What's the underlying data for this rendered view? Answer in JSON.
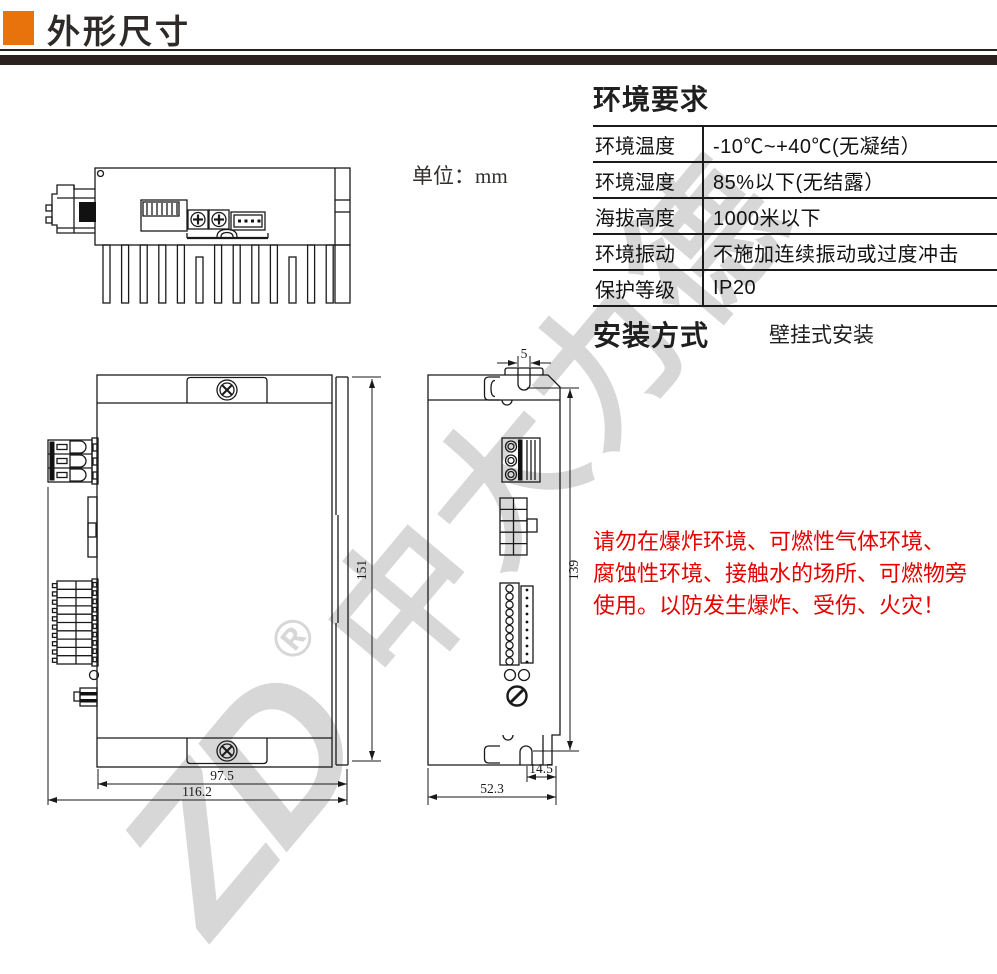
{
  "header": {
    "title": "外形尺寸"
  },
  "unit": {
    "label": "单位：",
    "value": "mm"
  },
  "environment": {
    "heading": "环境要求",
    "rows": [
      {
        "label": "环境温度",
        "value": "-10℃~+40℃(无凝结）"
      },
      {
        "label": "环境湿度",
        "value": "85%以下(无结露）"
      },
      {
        "label": "海拔高度",
        "value": "1000米以下"
      },
      {
        "label": "环境振动",
        "value": "不施加连续振动或过度冲击"
      },
      {
        "label": "保护等级",
        "value": "IP20"
      }
    ]
  },
  "installation": {
    "heading": "安装方式",
    "value": "壁挂式安装"
  },
  "warning": {
    "color": "#e60000",
    "lines": [
      "请勿在爆炸环境、可燃性气体环境、",
      "腐蚀性环境、接触水的场所、可燃物旁",
      "使用。以防发生爆炸、受伤、火灾！"
    ]
  },
  "watermark": {
    "logo": "ZD",
    "reg": "®",
    "text": "中大力德"
  },
  "drawing": {
    "dims": {
      "front_body_width": "97.5",
      "front_total_width": "116.2",
      "front_height": "151",
      "side_slot": "5",
      "side_height": "139",
      "side_slot_offset": "14.5",
      "side_depth": "52.3"
    }
  },
  "colors": {
    "accent_orange": "#e8720c",
    "rule_dark": "#2b211d",
    "line": "#1a1a1a"
  }
}
